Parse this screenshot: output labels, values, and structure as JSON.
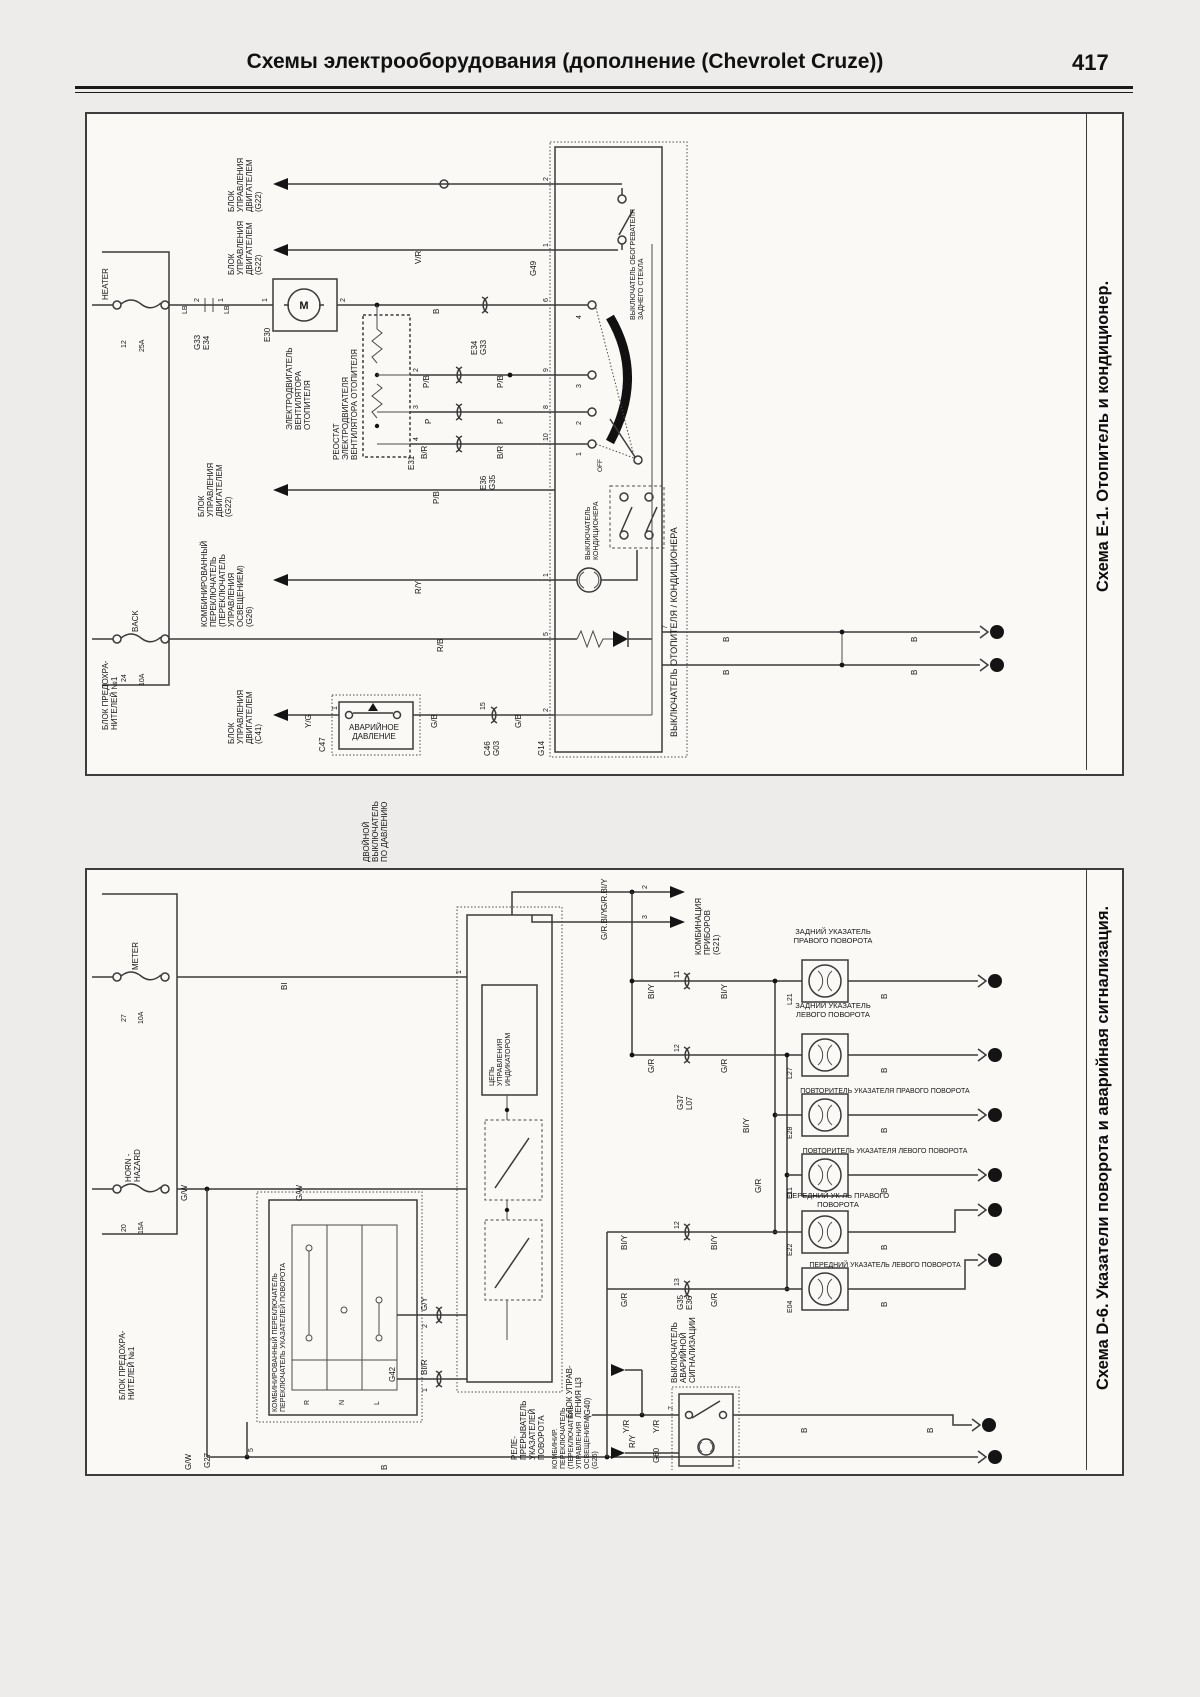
{
  "header": {
    "title": "Схемы электрооборудования (дополнение (Chevrolet Cruze))",
    "page": "417"
  },
  "wires": {
    "vr": "V/R",
    "pb": "P/B",
    "p": "P",
    "br": "B/R",
    "ry": "R/Y",
    "rb": "R/B",
    "yg": "Y/G",
    "gb": "G/B",
    "b": "B",
    "lb": "LB",
    "bi": "BI",
    "gw": "G/W",
    "gy": "G/Y",
    "bir": "BI/R",
    "biy": "BI/Y",
    "gr": "G/R",
    "yr": "Y/R",
    "grbiy": "G/R.BI/Y"
  },
  "pins": {
    "n1": "1",
    "n2": "2",
    "n3": "3",
    "n4": "4",
    "n5": "5",
    "n6": "6",
    "n7": "7",
    "n8": "8",
    "n9": "9",
    "n10": "10",
    "n11": "11",
    "n12": "12",
    "n13": "13",
    "n15": "15"
  },
  "e1": {
    "caption": "Схема Е-1. Отопитель и кондиционер.",
    "fuse_block": "БЛОК ПРЕДОХРА-\nНИТЕЛЕЙ №1",
    "fuse_heater": "HEATER",
    "fuse_heater_no": "12",
    "fuse_heater_amp": "25A",
    "fuse_back": "BACK",
    "fuse_back_no": "24",
    "fuse_back_amp": "10A",
    "ecm_g22": "БЛОК\nУПРАВЛЕНИЯ\nДВИГАТЕЛЕМ\n(G22)",
    "ecm_c41": "БЛОК\nУПРАВЛЕНИЯ\nДВИГАТЕЛЕМ\n(C41)",
    "combo": "КОМБИНИРОВАННЫЙ\nПЕРЕКЛЮЧАТЕЛЬ\n(ПЕРЕКЛЮЧАТЕЛЬ\nУПРАВЛЕНИЯ\nОСВЕЩЕНИЕМ)\n(G26)",
    "g33e34": "G33\nE34",
    "e30": "E30",
    "motor_m": "М",
    "motor": "ЭЛЕКТРОДВИГАТЕЛЬ\nВЕНТИЛЯТОРА\nОТОПИТЕЛЯ",
    "rheostat": "РЕОСТАТ\nЭЛЕКТРОДВИГАТЕЛЯ\nВЕНТИЛЯТОРА ОТОПИТЕЛЯ",
    "e31": "E31",
    "e34g33": "E34\nG33",
    "e36g35": "E36\nG35",
    "g49": "G49",
    "defog": "ВЫКЛЮЧАТЕЛЬ ОБОГРЕВАТЕЛЯ\nЗАДНЕГО СТЕКЛА",
    "acsw": "ВЫКЛЮЧАТЕЛЬ\nКОНДИЦИОНЕРА",
    "off": "OFF",
    "boxcap": "ВЫКЛЮЧАТЕЛЬ ОТОПИТЕЛЯ / КОНДИЦИОНЕРА",
    "c47": "C47",
    "pressure": "АВАРИЙНОЕ\nДАВЛЕНИЕ",
    "c46g03": "C46\nG03",
    "g14": "G14",
    "dual_pressure": "ДВОЙНОЙ\nВЫКЛЮЧАТЕЛЬ\nПО ДАВЛЕНИЮ"
  },
  "d6": {
    "caption": "Схема D-6. Указатели поворота и аварийная сигнализация.",
    "fuse_block": "БЛОК ПРЕДОХРА-\nНИТЕЛЕЙ №1",
    "fuse_meter": "METER",
    "fuse_meter_no": "27",
    "fuse_meter_amp": "10A",
    "fuse_horn": "HORN -\nHAZARD",
    "fuse_horn_no": "20",
    "fuse_horn_amp": "15A",
    "combo_sw": "КОМБИНИРОВАННЫЙ ПЕРЕКЛЮЧАТЕЛЬ\nПЕРЕКЛЮЧАТЕЛЬ УКАЗАТЕЛЕЙ ПОВОРОТА",
    "pos_r": "R",
    "pos_n": "N",
    "pos_l": "L",
    "g27": "G27",
    "g42": "G42",
    "relay": "РЕЛЕ-\nПРЕРЫВАТЕЛЬ\nУКАЗАТЕЛЕЙ\nПОВОРОТА",
    "ind_circuit": "ЦЕПЬ\nУПРАВЛЕНИЯ\nИНДИКАТОРОМ",
    "cluster": "КОМБИНАЦИЯ\nПРИБОРОВ\n(G21)",
    "g37l07": "G37\nL07",
    "g35e36": "G35\nE36",
    "lamp_l21": "ЗАДНИЙ УКАЗАТЕЛЬ\nПРАВОГО ПОВОРОТА",
    "l21": "L21",
    "lamp_l27": "ЗАДНИЙ УКАЗАТЕЛЬ\nЛЕВОГО ПОВОРОТА",
    "l27": "L27",
    "lamp_e28": "ПОВТОРИТЕЛЬ УКАЗАТЕЛЯ ПРАВОГО ПОВОРОТА",
    "e28": "E28",
    "lamp_e11": "ПОВТОРИТЕЛЬ УКАЗАТЕЛЯ ЛЕВОГО ПОВОРОТА",
    "e11": "E11",
    "lamp_e22": "ПЕРЕДНИЙ УК-ЛЬ ПРАВОГО\nПОВОРОТА",
    "e22": "E22",
    "lamp_e04": "ПЕРЕДНИЙ УКАЗАТЕЛЬ ЛЕВОГО ПОВОРОТА",
    "e04": "E04",
    "hazard": "ВЫКЛЮЧАТЕЛЬ\nАВАРИЙНОЙ\nСИГНАЛИЗАЦИИ",
    "g60": "G60",
    "ccu": "БЛОК УПРАВ-\nЛЕНИЯ ЦЗ\n(G40)",
    "combo_light": "КОМБИНИР.\nПЕРЕКЛЮЧАТЕЛЬ\n(ПЕРЕКЛЮЧАТЕЛЬ\nУПРАВЛЕНИЯ\nОСВЕЩЕНИЕМ)\n(G26)"
  }
}
